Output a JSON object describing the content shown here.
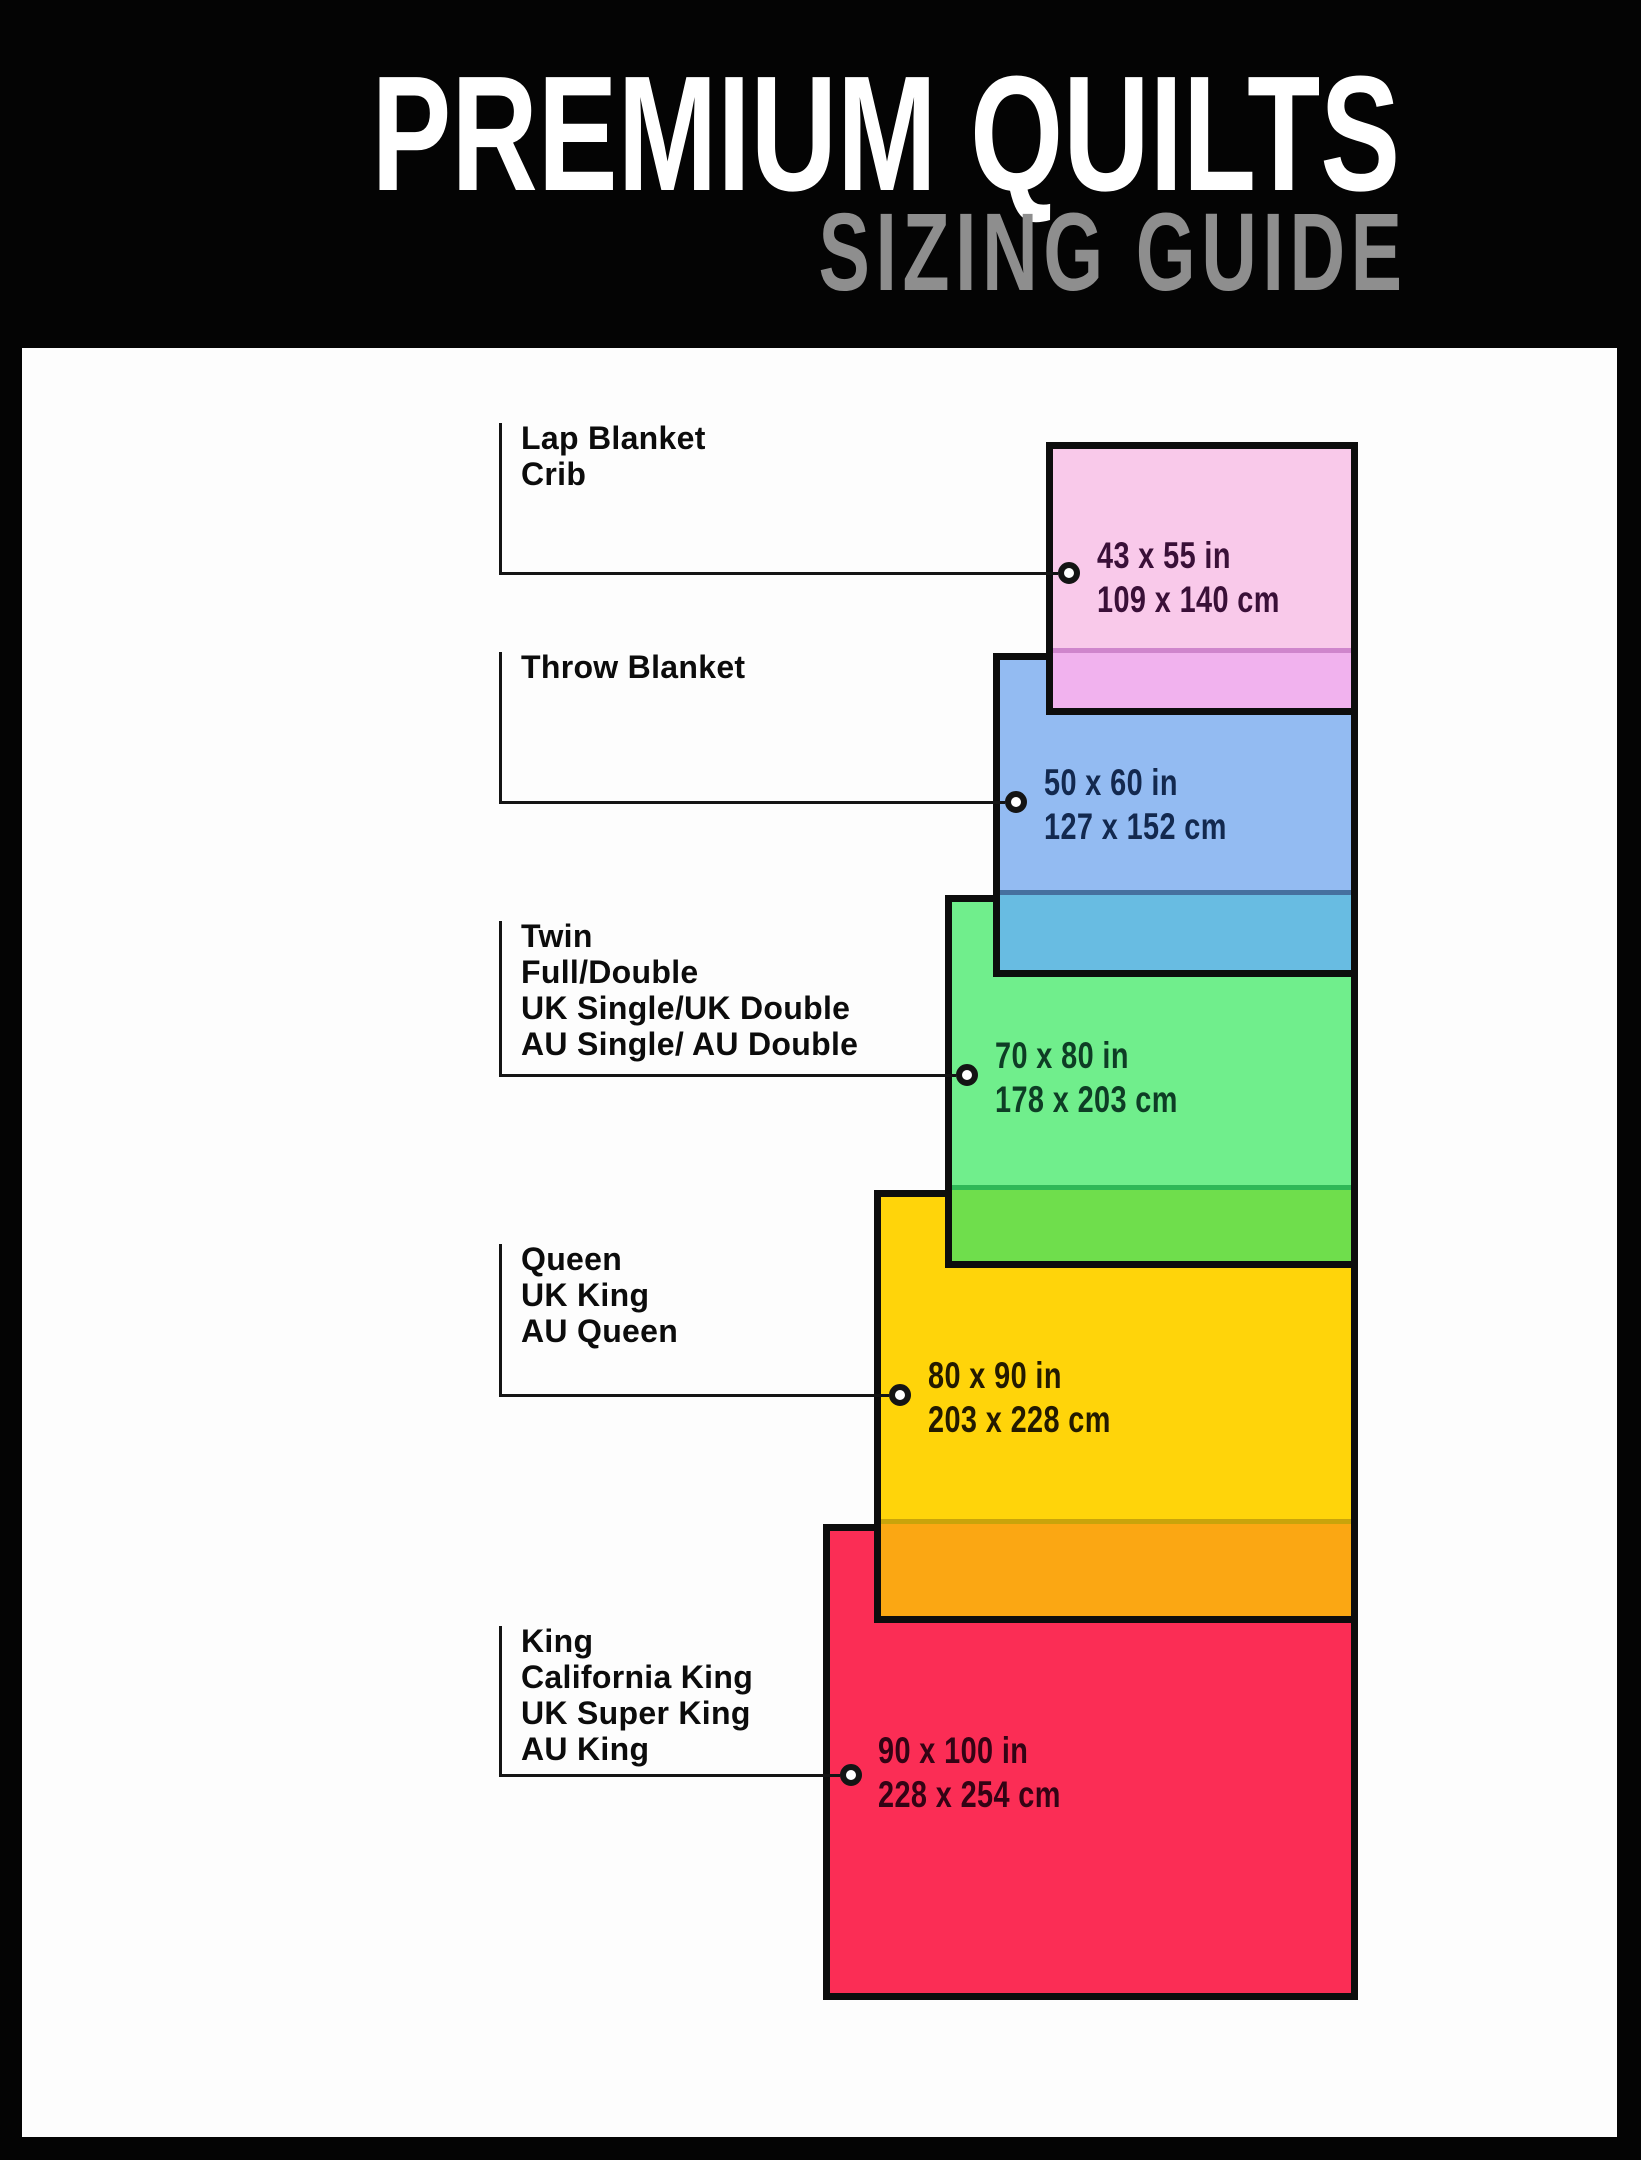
{
  "header": {
    "title": "PREMIUM QUILTS",
    "subtitle": "SIZING GUIDE",
    "background": "#040404",
    "title_color": "#ffffff",
    "subtitle_color": "#8e8e8e"
  },
  "sizes": [
    {
      "id": "lap-blanket-crib",
      "labels": [
        "Lap Blanket",
        "Crib"
      ],
      "inches": "43 x 55 in",
      "cm": "109 x 140 cm",
      "fill": "#f9c9ea",
      "overlap_fill": "#f1b2ee",
      "overlap_line": "#cf85cc",
      "text_color": "#3a1038"
    },
    {
      "id": "throw-blanket",
      "labels": [
        "Throw Blanket"
      ],
      "inches": "50 x 60 in",
      "cm": "127 x 152 cm",
      "fill": "#93bbf2",
      "overlap_fill": "#68bce2",
      "overlap_line": "#46709f",
      "text_color": "#13294f"
    },
    {
      "id": "twin-full-double",
      "labels": [
        "Twin",
        "Full/Double",
        "UK Single/UK Double",
        "AU Single/ AU Double"
      ],
      "inches": "70 x 80 in",
      "cm": "178 x 203 cm",
      "fill": "#70ee8c",
      "overlap_fill": "#6fde4c",
      "overlap_line": "#2eb857",
      "text_color": "#0e3d25"
    },
    {
      "id": "queen",
      "labels": [
        "Queen",
        "UK King",
        "AU Queen"
      ],
      "inches": "80 x 90 in",
      "cm": "203 x 228 cm",
      "fill": "#ffd40a",
      "overlap_fill": "#fba713",
      "overlap_line": "#c9a40b",
      "text_color": "#231a00"
    },
    {
      "id": "king",
      "labels": [
        "King",
        "California King",
        "UK Super King",
        "AU King"
      ],
      "inches": "90 x 100 in",
      "cm": "228 x 254 cm",
      "fill": "#fb2d55",
      "overlap_fill": null,
      "overlap_line": null,
      "text_color": "#330314"
    }
  ]
}
